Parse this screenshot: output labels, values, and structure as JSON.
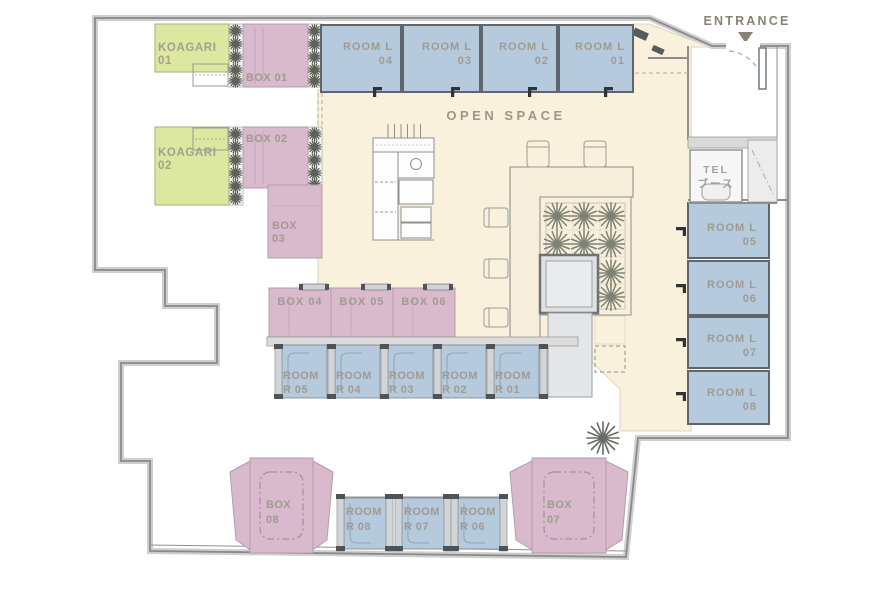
{
  "entrance_label": "ENTRANCE",
  "open_space_label": "OPEN SPACE",
  "tel": {
    "line1": "TEL",
    "line2": "ブース"
  },
  "koagari": [
    {
      "line1": "KOAGARI",
      "line2": "01"
    },
    {
      "line1": "KOAGARI",
      "line2": "02"
    }
  ],
  "boxes": {
    "b01": "BOX 01",
    "b02": "BOX 02",
    "b03_line1": "BOX",
    "b03_line2": "03",
    "b04": "BOX 04",
    "b05": "BOX 05",
    "b06": "BOX 06",
    "b07_line1": "BOX",
    "b07_line2": "07",
    "b08_line1": "BOX",
    "b08_line2": "08"
  },
  "rooms_l_top": [
    {
      "line1": "ROOM L",
      "line2": "04"
    },
    {
      "line1": "ROOM L",
      "line2": "03"
    },
    {
      "line1": "ROOM L",
      "line2": "02"
    },
    {
      "line1": "ROOM L",
      "line2": "01"
    }
  ],
  "rooms_l_right": [
    {
      "line1": "ROOM L",
      "line2": "05"
    },
    {
      "line1": "ROOM L",
      "line2": "06"
    },
    {
      "line1": "ROOM L",
      "line2": "07"
    },
    {
      "line1": "ROOM L",
      "line2": "08"
    }
  ],
  "rooms_r_mid": [
    {
      "line1": "ROOM",
      "line2": "R 05"
    },
    {
      "line1": "ROOM",
      "line2": "R 04"
    },
    {
      "line1": "ROOM",
      "line2": "R 03"
    },
    {
      "line1": "ROOM",
      "line2": "R 02"
    },
    {
      "line1": "ROOM",
      "line2": "R 01"
    }
  ],
  "rooms_r_bottom": [
    {
      "line1": "ROOM",
      "line2": "R 08"
    },
    {
      "line1": "ROOM",
      "line2": "R 07"
    },
    {
      "line1": "ROOM",
      "line2": "R 06"
    }
  ],
  "colors": {
    "room_blue": "#b6cade",
    "box_pink": "#d8bacc",
    "koagari_green": "#dce79f",
    "open_space_cream": "#faf1dd",
    "floor_gray": "#e9e9ea",
    "pillar_gray": "#dfe1e3",
    "entrance_brown": "#8a8374",
    "label_gray": "#9f9b91",
    "wall_gray": "#8a8a8b"
  }
}
